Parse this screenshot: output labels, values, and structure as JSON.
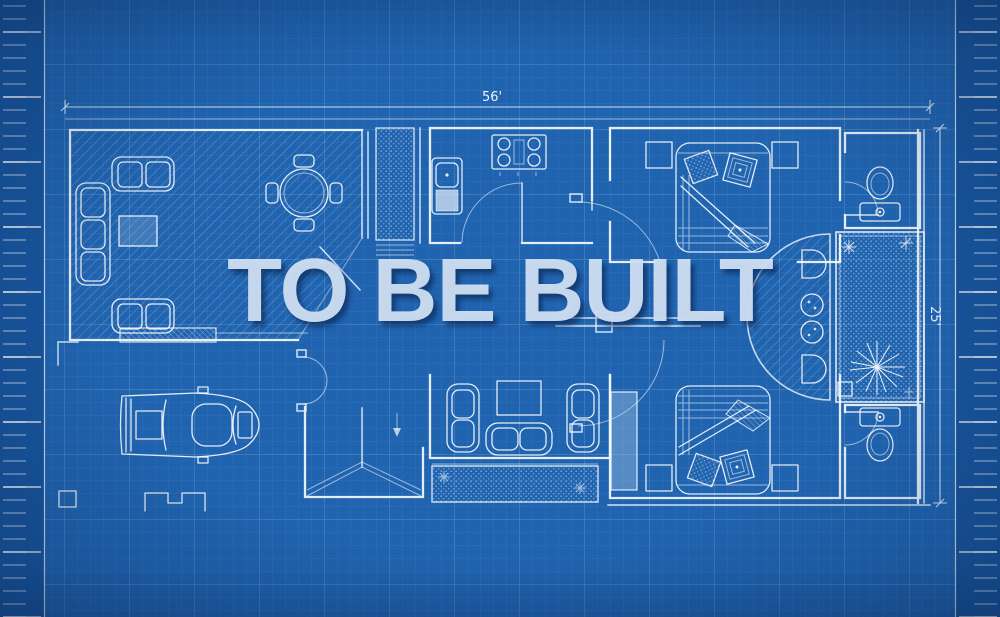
{
  "watermark": {
    "text": "TO BE BUILT"
  },
  "dimensions": {
    "top_width": "56'",
    "right_height": "25'"
  },
  "palette": {
    "background": "#1a60ae",
    "margin": "#12519b",
    "grid_minor": "rgba(255,255,255,0.08)",
    "grid_major": "rgba(255,255,255,0.20)",
    "wall_line": "#edf4fb",
    "watermark": "rgba(208,223,242,0.95)",
    "watermark_shadow": "rgba(7,30,70,0.55)"
  },
  "icons": [
    "sofa-icon",
    "loveseat-icon",
    "coffee-table-icon",
    "dining-table-icon",
    "stove-icon",
    "sink-unit-icon",
    "bed-icon",
    "pillow-icon",
    "nightstand-icon",
    "toilet-icon",
    "door-swing-icon",
    "plant-icon",
    "sparkle-icon",
    "car-icon",
    "armchair-icon",
    "tv-icon",
    "stairs-icon",
    "seat-icon",
    "ruler-icon"
  ]
}
